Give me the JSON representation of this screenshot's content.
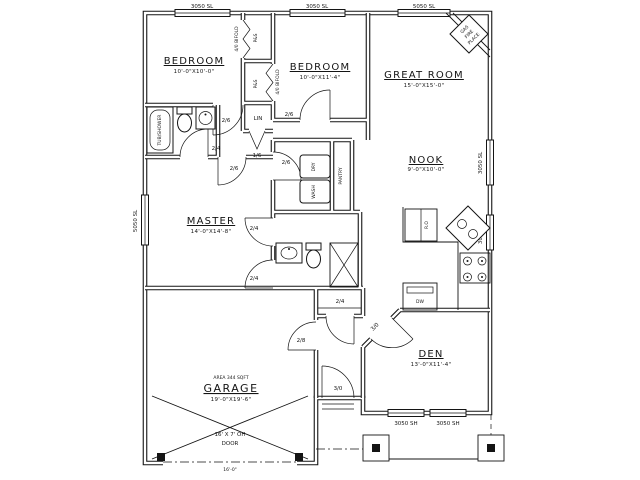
{
  "plan": {
    "rooms": {
      "bedroom1": {
        "name": "BEDROOM",
        "dims": "10'-0\"X10'-0\""
      },
      "bedroom2": {
        "name": "BEDROOM",
        "dims": "10'-0\"X11'-4\""
      },
      "great_room": {
        "name": "GREAT ROOM",
        "dims": "15'-0\"X15'-0\""
      },
      "nook": {
        "name": "NOOK",
        "dims": "9'-0\"X10'-0\""
      },
      "master": {
        "name": "MASTER",
        "dims": "14'-0\"X14'-8\""
      },
      "den": {
        "name": "DEN",
        "dims": "13'-0\"X11'-4\""
      },
      "garage": {
        "area": "AREA 344 SQFT",
        "name": "GARAGE",
        "dims": "19'-0\"X19'-6\""
      }
    },
    "fixtures": {
      "tub": "TUB/SHOWER",
      "linen": "LIN",
      "dry": "DRY",
      "wash": "WASH",
      "pantry": "PANTRY",
      "fridge": "R.O",
      "dishwasher": "DW",
      "fireplace1": "GAS",
      "fireplace2": "FIRE",
      "fireplace3": "PLACE",
      "closet1_door": "4/0 BIFOLD",
      "closet2_door": "4/0 BIFOLD",
      "shelf1": "P&S",
      "shelf2": "P&S"
    },
    "windows": {
      "top1": "3050 SL",
      "top2": "3050 SL",
      "top3": "5050 SL",
      "left1": "5050 SL",
      "right1": "3050 SL",
      "right2": "3050 SL",
      "den1": "3050 SH",
      "den2": "3050 SH"
    },
    "doors": {
      "bed1": "2/6",
      "bed2": "2/6",
      "linen": "1/6",
      "bath": "2/4",
      "master": "2/6",
      "laundry": "2/6",
      "mbath_upper": "2/4",
      "mbath_lower": "2/4",
      "coat": "2/4",
      "garage": "2/8",
      "front": "3/0",
      "den": "3/0"
    },
    "garage_door": {
      "size": "16' X 7' OH",
      "label": "DOOR",
      "dim": "16'-0\""
    }
  }
}
